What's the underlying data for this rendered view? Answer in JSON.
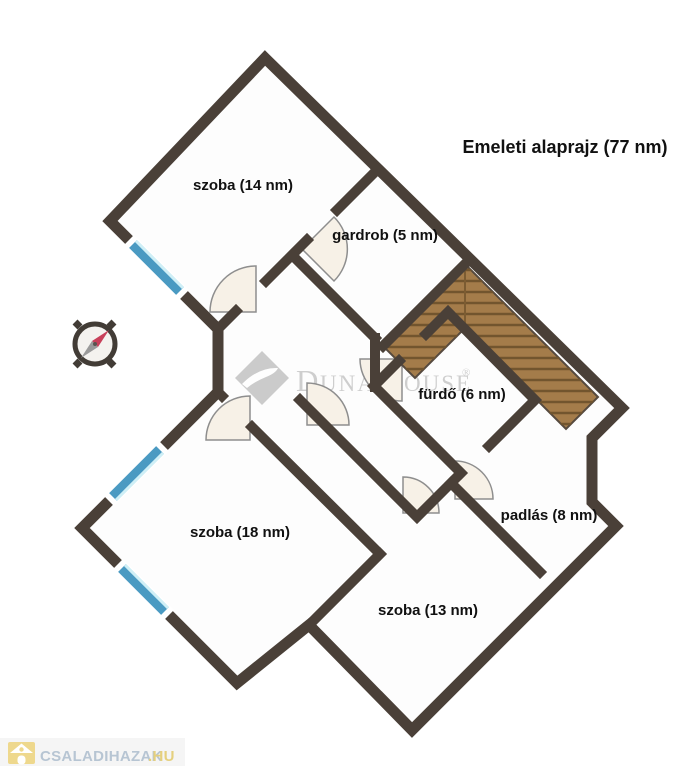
{
  "title": "Emeleti alaprajz (77 nm)",
  "rooms": {
    "szoba14": "szoba (14 nm)",
    "gardrob": "gardrob (5 nm)",
    "furdo": "fürdő (6 nm)",
    "padlas": "padlás (8 nm)",
    "szoba18": "szoba (18 nm)",
    "szoba13": "szoba (13 nm)"
  },
  "watermark": {
    "part1": "D",
    "part2": "UNA",
    "part3": "H",
    "part4": "OUSE",
    "reg": "®"
  },
  "footer": {
    "brand": "CSALADIHAZAK",
    "tld": ".HU"
  },
  "icons": {
    "compass": "compass-rose",
    "logo": "dunahouse-diamond-swoosh",
    "footer_house": "house-icon"
  },
  "colors": {
    "wall": "#4a4038",
    "floor": "#fdfdfd",
    "stairs": "#a47c4a",
    "stair_tread": "#72552e",
    "window_blue": "#4a9ac2",
    "window_light": "#cfeff6",
    "door_fill": "#f7f1e7",
    "door_stroke": "#8e8e8e",
    "watermark_gray": "#c9c9c9",
    "brand_blue": "#b7c5d3",
    "brand_gold": "#e5d07e",
    "compass_red": "#c8405a"
  }
}
